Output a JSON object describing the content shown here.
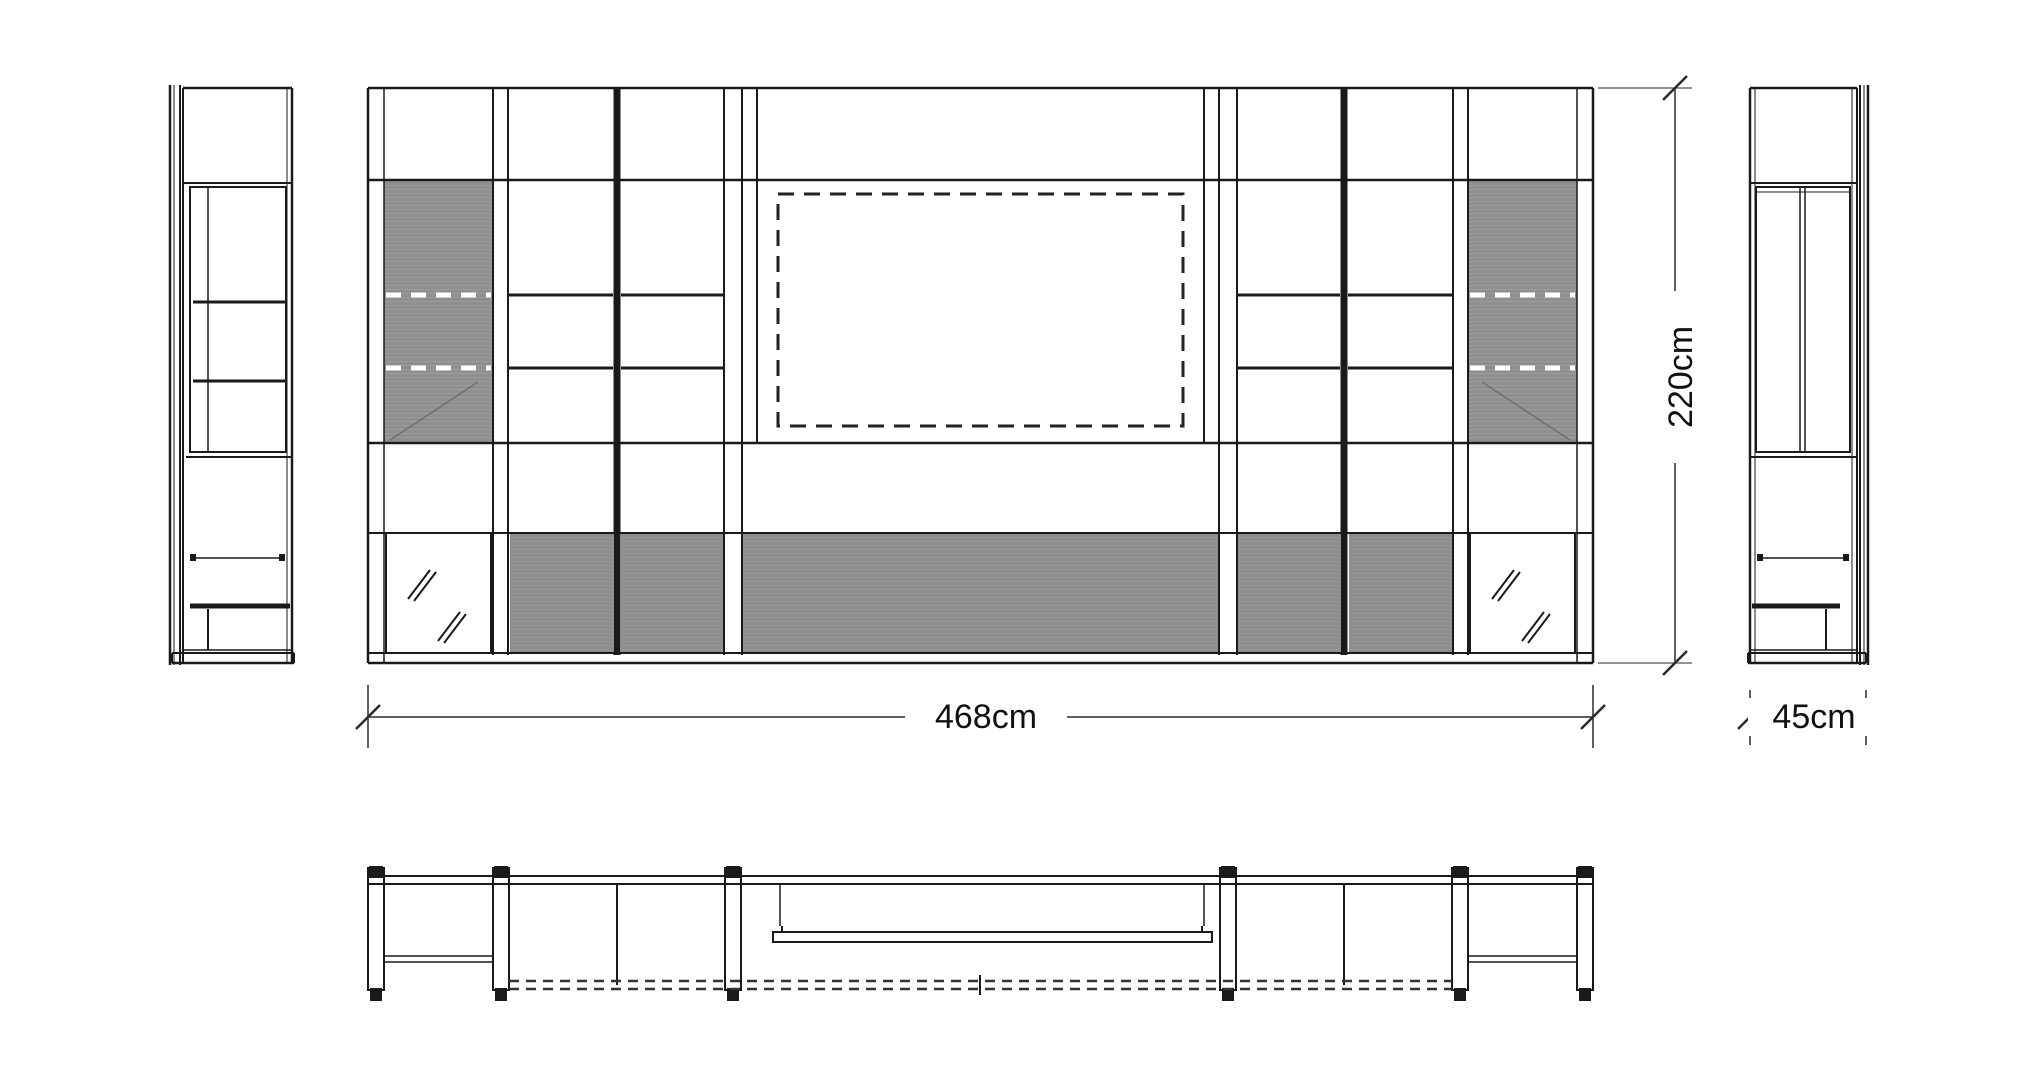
{
  "dims": {
    "width": "468cm",
    "height": "220cm",
    "depth": "45cm"
  },
  "colors": {
    "line": "#1a1a1a",
    "panel_gray": "#8f8f8f",
    "base_gray": "#8d8d8d",
    "glass_dash_white": "#ffffff",
    "background": "#ffffff"
  }
}
